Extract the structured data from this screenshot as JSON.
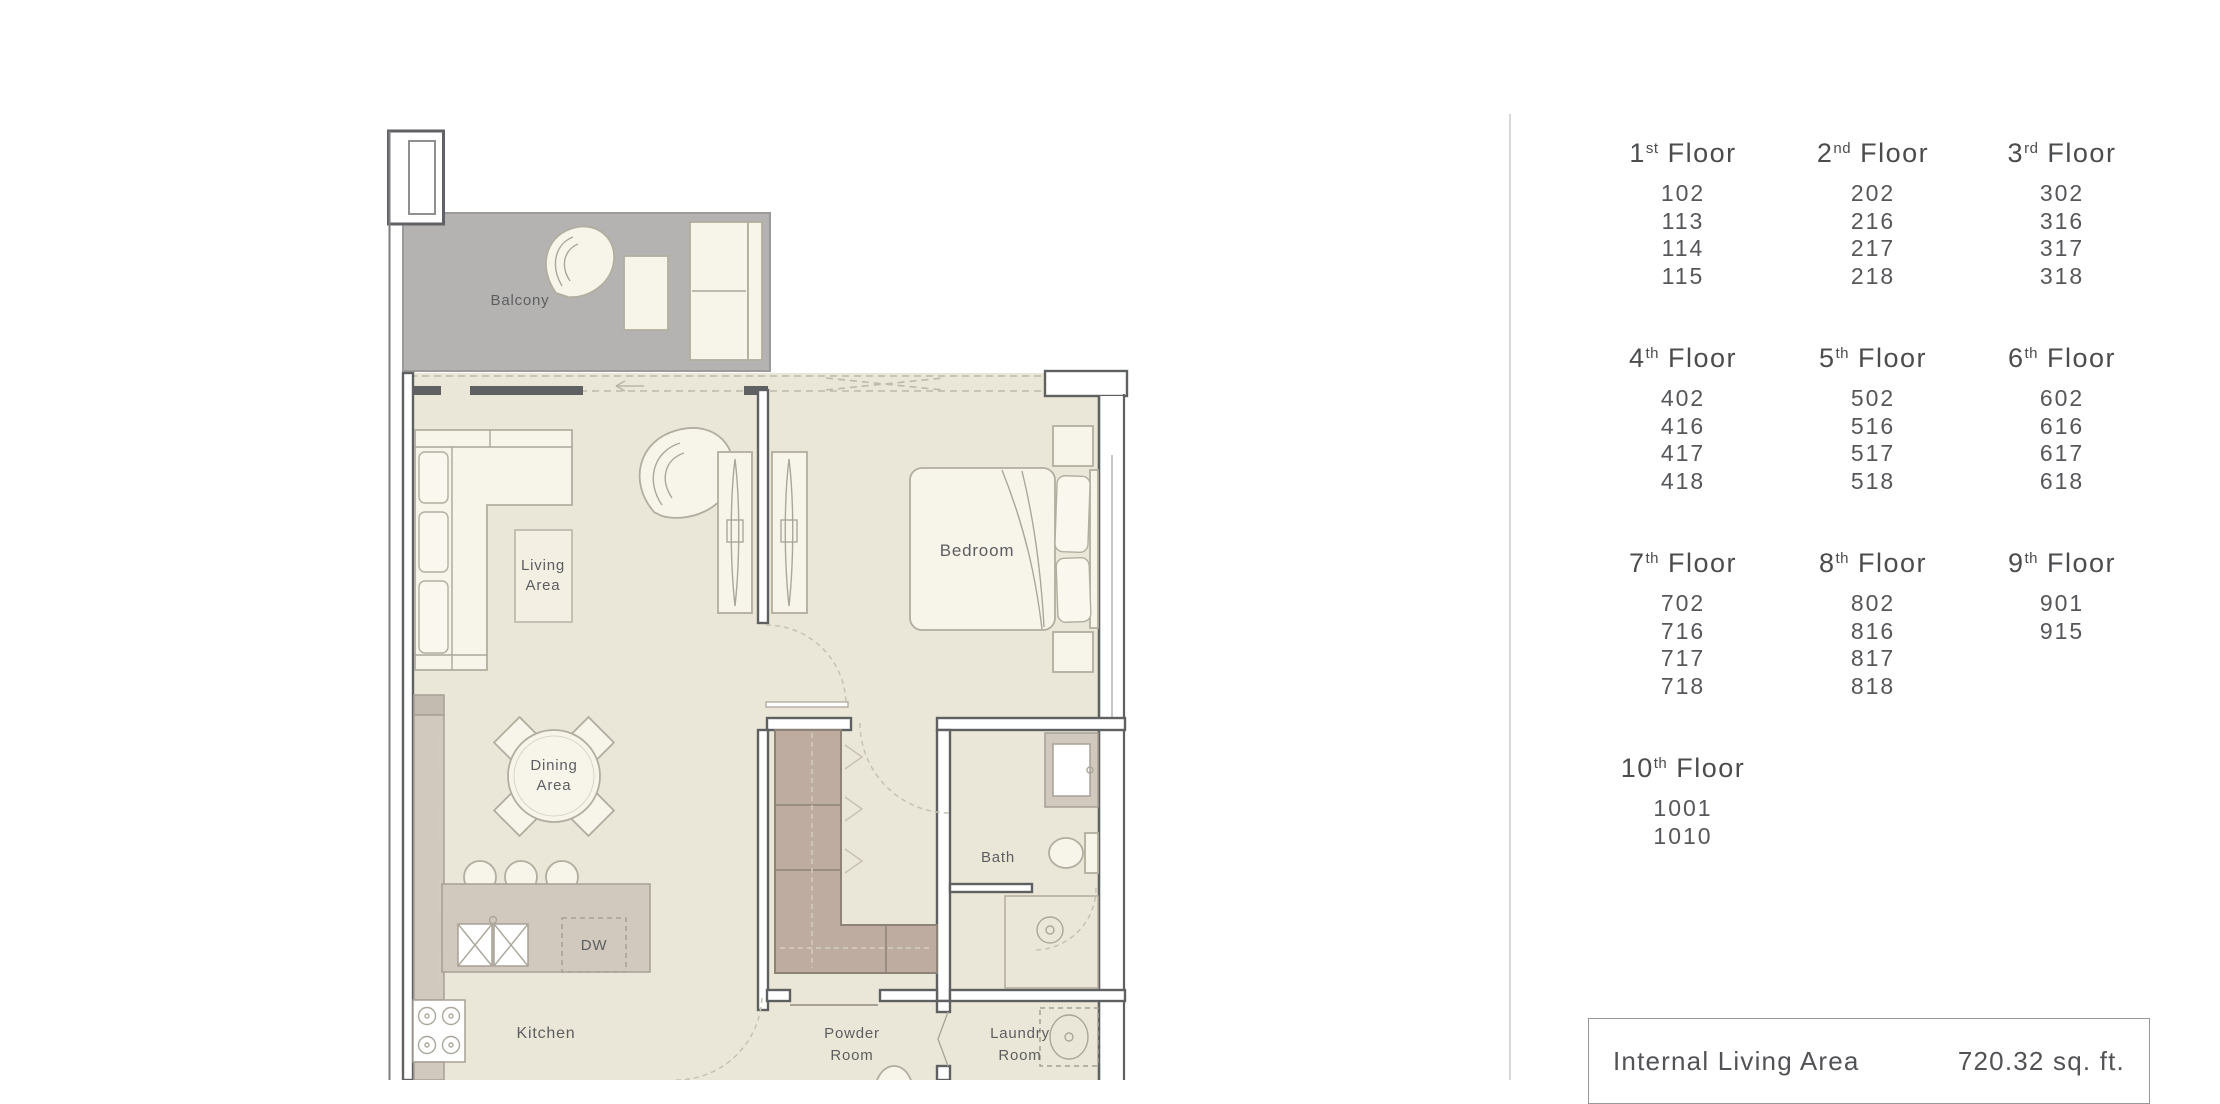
{
  "floor_plan": {
    "labels": {
      "balcony": "Balcony",
      "living1": "Living",
      "living2": "Area",
      "bedroom": "Bedroom",
      "dining1": "Dining",
      "dining2": "Area",
      "dw": "DW",
      "kitchen": "Kitchen",
      "bath": "Bath",
      "powder1": "Powder",
      "powder2": "Room",
      "laundry1": "Laundry",
      "laundry2": "Room"
    },
    "colors": {
      "floor": "#ebe7d8",
      "balcony": "#b5b3b1",
      "wall": "#5f6062",
      "counter": "#d2c9be",
      "wardrobe": "#bdac9f",
      "furniture": "#f7f4ea",
      "outline": "#b2ae9f",
      "label": "#5d5e60"
    }
  },
  "floors_panel": {
    "floor_word": "Floor",
    "floors": [
      {
        "number": "1",
        "suffix": "st",
        "units": [
          "102",
          "113",
          "114",
          "115"
        ]
      },
      {
        "number": "2",
        "suffix": "nd",
        "units": [
          "202",
          "216",
          "217",
          "218"
        ]
      },
      {
        "number": "3",
        "suffix": "rd",
        "units": [
          "302",
          "316",
          "317",
          "318"
        ]
      },
      {
        "number": "4",
        "suffix": "th",
        "units": [
          "402",
          "416",
          "417",
          "418"
        ]
      },
      {
        "number": "5",
        "suffix": "th",
        "units": [
          "502",
          "516",
          "517",
          "518"
        ]
      },
      {
        "number": "6",
        "suffix": "th",
        "units": [
          "602",
          "616",
          "617",
          "618"
        ]
      },
      {
        "number": "7",
        "suffix": "th",
        "units": [
          "702",
          "716",
          "717",
          "718"
        ]
      },
      {
        "number": "8",
        "suffix": "th",
        "units": [
          "802",
          "816",
          "817",
          "818"
        ]
      },
      {
        "number": "9",
        "suffix": "th",
        "units": [
          "901",
          "915"
        ]
      },
      {
        "number": "10",
        "suffix": "th",
        "units": [
          "1001",
          "1010"
        ]
      }
    ]
  },
  "summary_box": {
    "label": "Internal Living Area",
    "value": "720.32 sq. ft."
  }
}
